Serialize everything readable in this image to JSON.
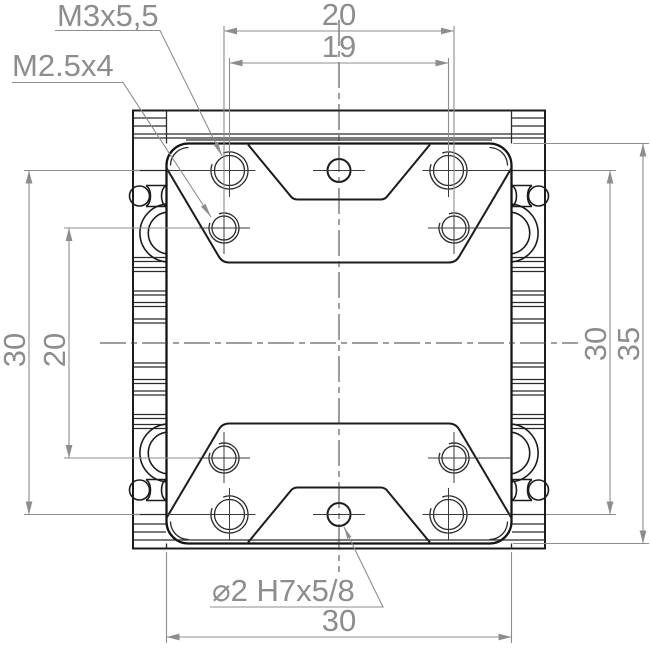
{
  "drawing": {
    "callouts": {
      "m3": "M3x5,5",
      "m2_5": "M2.5x4",
      "bore": "⌀2 H7x5/8"
    },
    "dimensions": {
      "top_outer": "20",
      "top_inner": "19",
      "left_outer": "30",
      "left_inner": "20",
      "right_inner": "30",
      "right_outer": "35",
      "bottom": "30"
    },
    "colors": {
      "geometry_line": "#1c1c1c",
      "dimension_line": "#8d8d8d",
      "background": "#ffffff"
    }
  }
}
